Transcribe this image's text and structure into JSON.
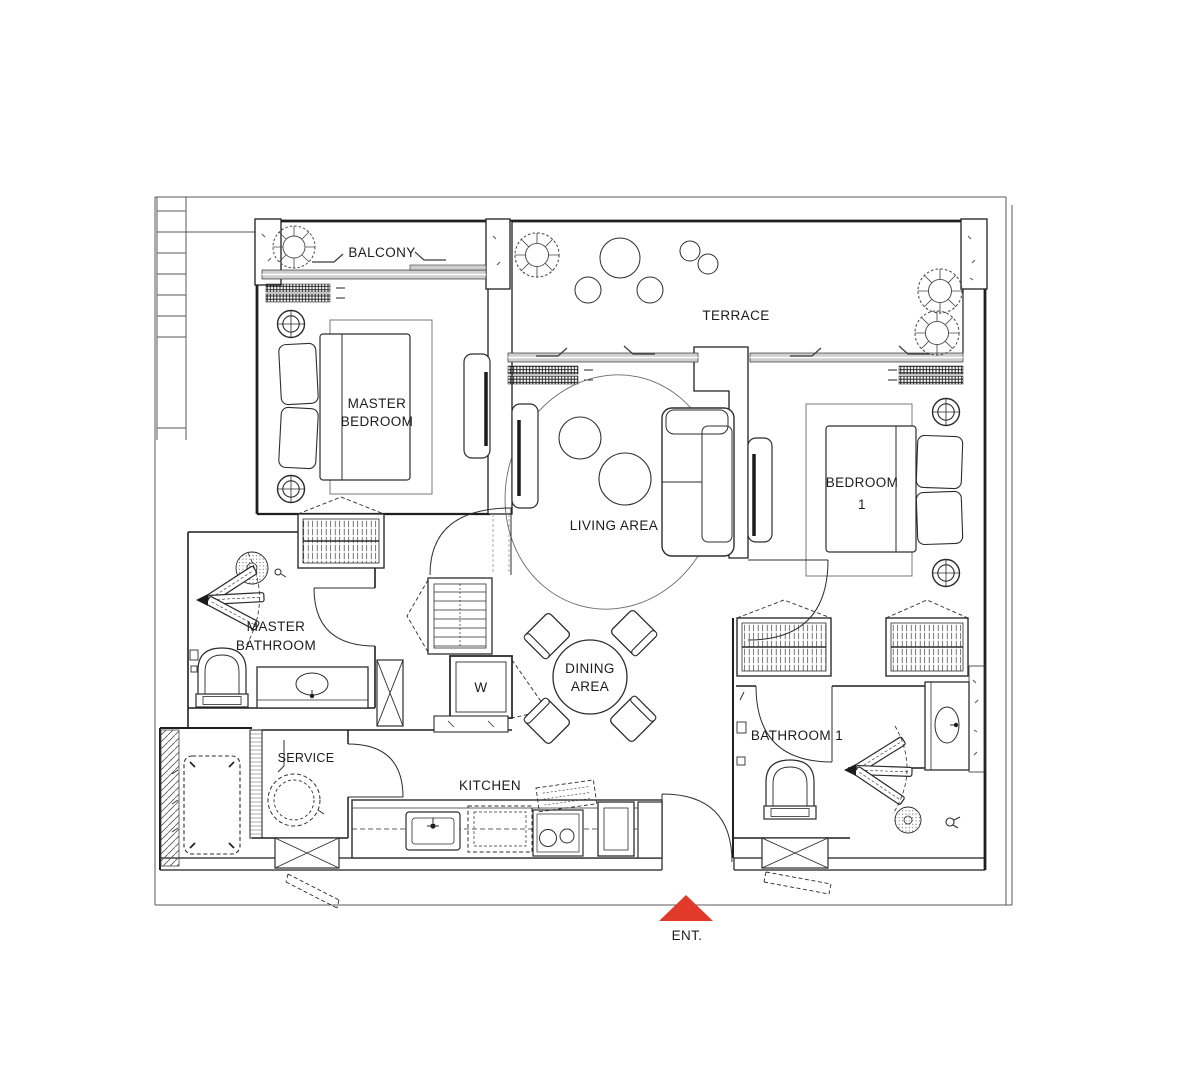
{
  "rooms": {
    "balcony": "BALCONY",
    "terrace": "TERRACE",
    "master_bedroom_l1": "MASTER",
    "master_bedroom_l2": "BEDROOM",
    "living_area": "LIVING AREA",
    "bedroom1_l1": "BEDROOM",
    "bedroom1_l2": "1",
    "master_bathroom_l1": "MASTER",
    "master_bathroom_l2": "BATHROOM",
    "dining_l1": "DINING",
    "dining_l2": "AREA",
    "service": "SERVICE",
    "kitchen": "KITCHEN",
    "bathroom1": "BATHROOM 1",
    "wardrobe_w": "W"
  },
  "entrance": {
    "label": "ENT.",
    "arrow_color": "#e23a2a"
  },
  "colors": {
    "wall_line": "#1f1f1f",
    "glass_fill": "#cfcfcf",
    "background": "#ffffff"
  }
}
